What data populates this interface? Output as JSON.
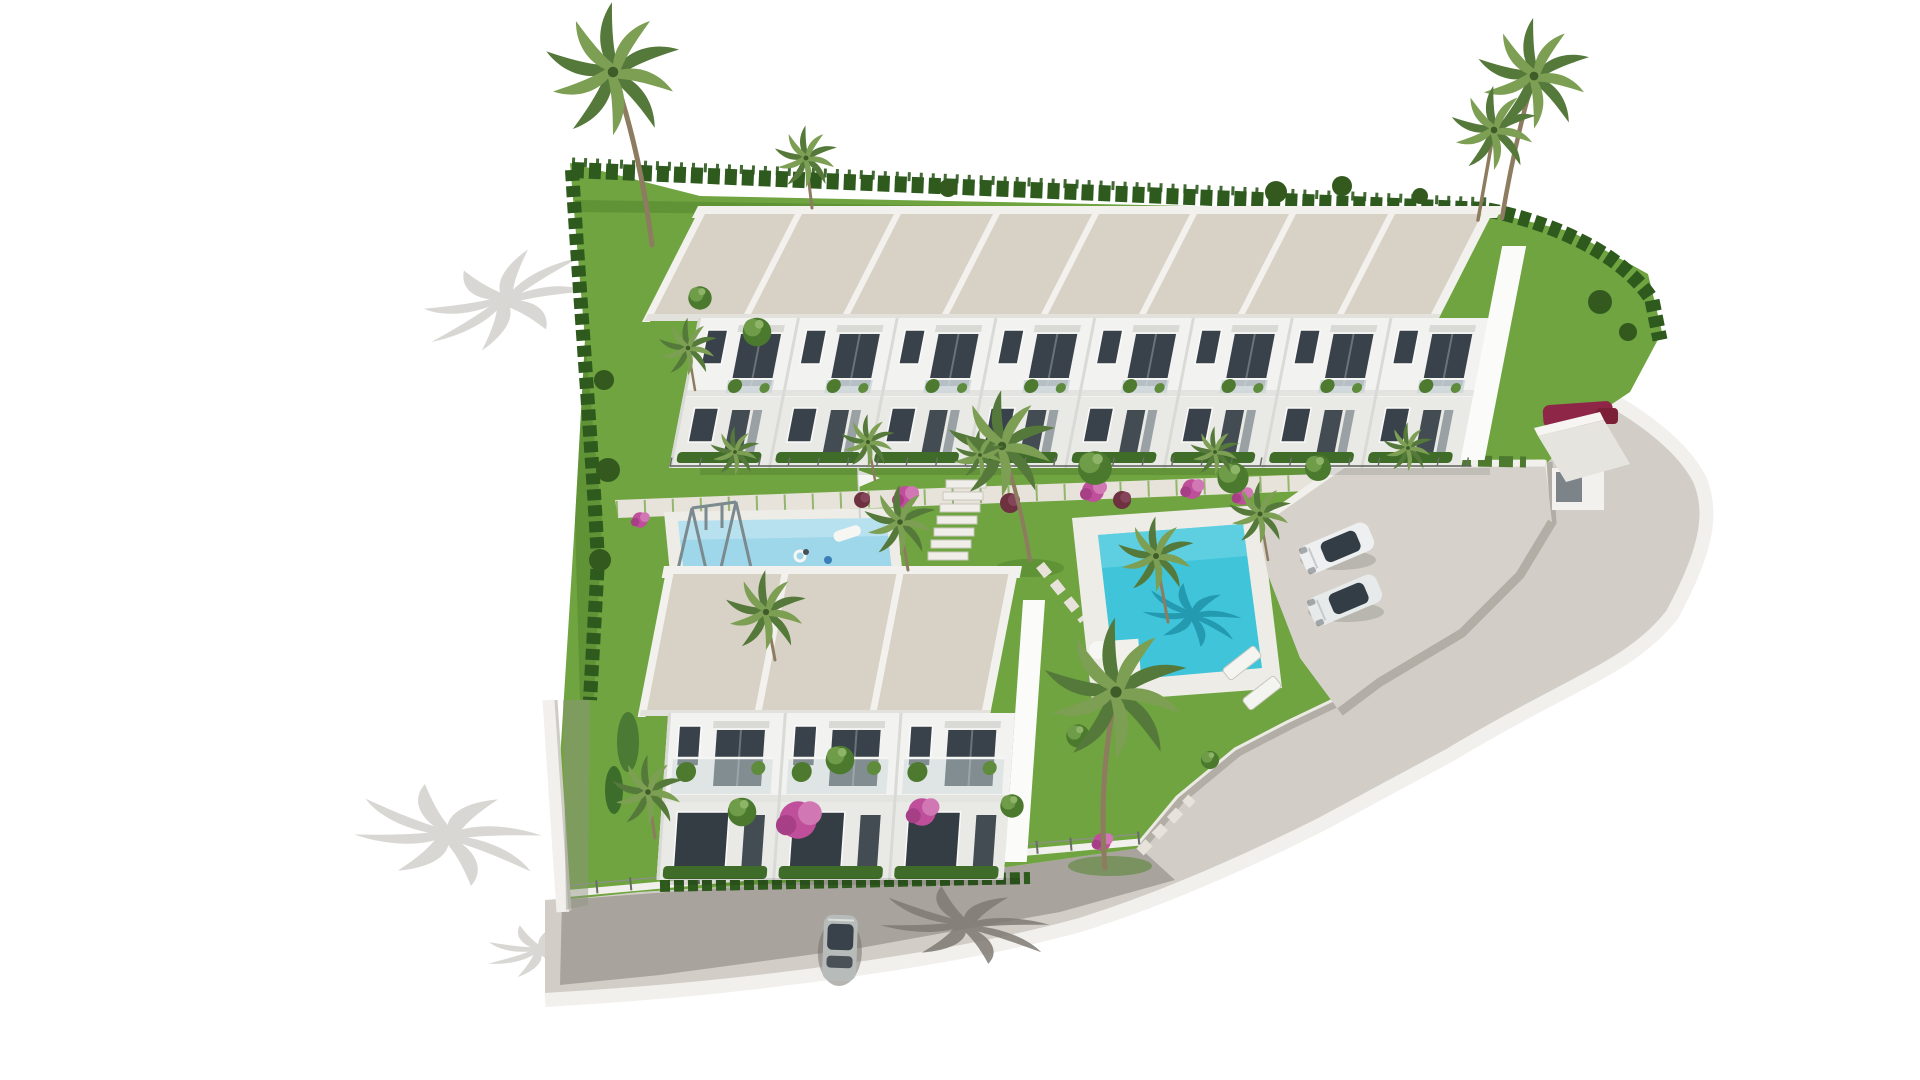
{
  "meta": {
    "title": "Aerial 3D architectural rendering of a gated townhouse development",
    "media_type": "architectural-visualization",
    "visible_text": "none"
  },
  "scene": {
    "buildings": {
      "top_row_units": 8,
      "bottom_row_units": 3,
      "stories_per_unit": 2,
      "roof_style": "flat gravel roofs with white parapets",
      "entrance_gatehouse": 1
    },
    "amenities": [
      "main swimming pool with sun deck",
      "children's pool with swing set and floats",
      "landscaped garden with stepping-stone paths and steps",
      "private parking court",
      "perimeter road and white boundary walls with wire fence"
    ],
    "vehicles": {
      "white_cars_in_parking": 2,
      "silver_car_on_street": 1,
      "red_car_at_entrance": 1
    },
    "vegetation": [
      "tall palm trees",
      "fan palms",
      "cypress hedges",
      "pink bougainvillea",
      "round garden shrubs",
      "lawns"
    ],
    "lighting": "bright daylight, shadows cast toward lower-left"
  },
  "colors": {
    "background": "#ffffff",
    "grass": "#6fa440",
    "grass_shade": "#54842e",
    "hedge": "#2e5a1e",
    "roof": "#d8d1c5",
    "parapet": "#f2f1ed",
    "facade": "#f2f2f0",
    "facade_ground": "#e9e9e6",
    "gable_wall": "#fbfbf9",
    "window": "#39424a",
    "pool_water": "#3fc4d9",
    "pool_shadow": "#1f93a8",
    "kids_pool_water": "#9ed6ea",
    "deck": "#eeece6",
    "path": "#e7e3da",
    "road": "#d2cec7",
    "street": "#a8a49d",
    "wall": "#f2f0ec",
    "retaining_wall": "#b2aea6",
    "fence_post": "#686d66",
    "shadow_on_white": "#d8d7d4",
    "shadow_on_street": "#7f7b74",
    "car_white": "#edeff0",
    "car_silver": "#b7bcba",
    "car_red": "#8e2747",
    "flower_pink": "#bf4f9a",
    "flower_dark": "#6e3140",
    "foliage": "#4b7a2e",
    "foliage_light": "#7d9f54",
    "trunk": "#8d7c5f"
  }
}
